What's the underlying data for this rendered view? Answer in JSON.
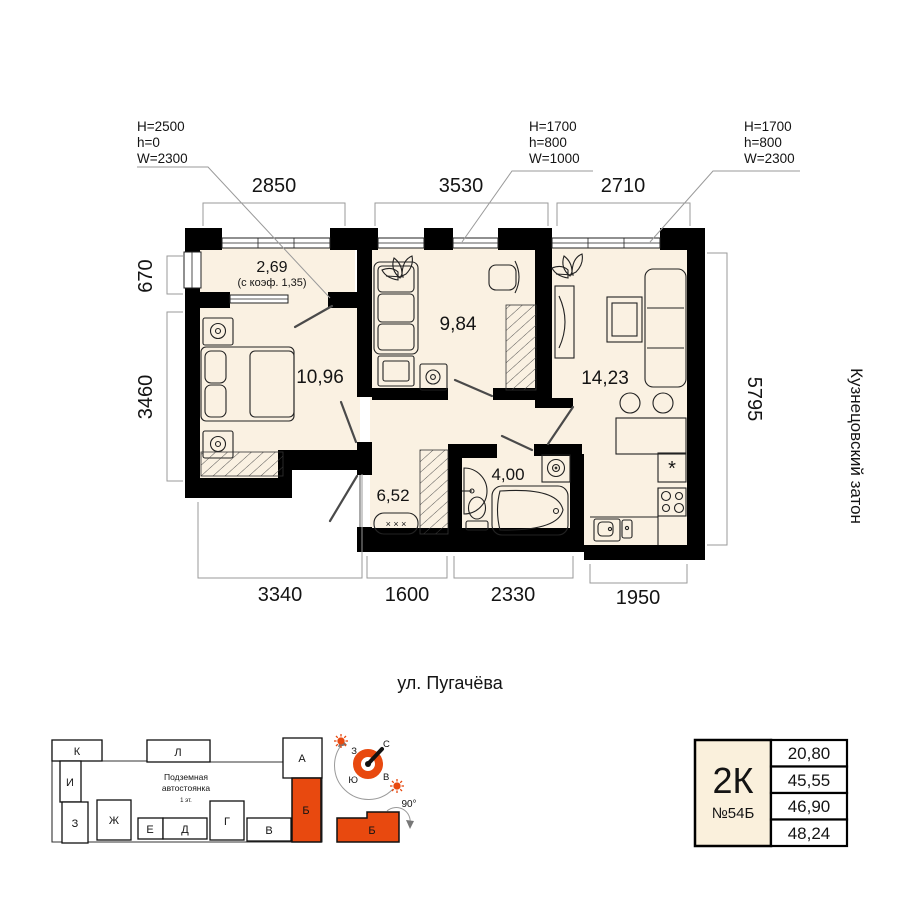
{
  "specs": [
    [
      "H=2500",
      "h=0",
      "W=2300"
    ],
    [
      "H=1700",
      "h=800",
      "W=1000"
    ],
    [
      "H=1700",
      "h=800",
      "W=2300"
    ]
  ],
  "dims": {
    "top": [
      "2850",
      "3530",
      "2710"
    ],
    "left": [
      "670",
      "3460"
    ],
    "right": [
      "5795"
    ],
    "bottom": [
      "3340",
      "1600",
      "2330",
      "1950"
    ]
  },
  "rooms": {
    "balcony_area": "2,69",
    "balcony_note": "(с коэф. 1,35)",
    "bedroom": "10,96",
    "room": "9,84",
    "living": "14,23",
    "hall": "6,52",
    "bath": "4,00"
  },
  "labels": {
    "district": "Кузнецовский затон",
    "street": "ул. Пугачёва"
  },
  "symbols": {
    "fridge": "*",
    "bench": "× × ×"
  },
  "site_plan": {
    "parking": [
      "Подземная",
      "автостоянка"
    ],
    "parking_note": "1 эт.",
    "highlight": "Б",
    "blocks": [
      "К",
      "Л",
      "А",
      "И",
      "Б",
      "З",
      "Ж",
      "Е",
      "Д",
      "Г",
      "В"
    ]
  },
  "compass": {
    "north": "С",
    "south": "Ю",
    "west": "З",
    "east": "В",
    "rotation": "90°",
    "block": "Б"
  },
  "info_box": {
    "type": "2К",
    "number": "№54Б",
    "areas": [
      "20,80",
      "45,55",
      "46,90",
      "48,24"
    ]
  },
  "colors": {
    "accent": "#e8490f",
    "floor": "#faf1e2",
    "wall": "#000000"
  }
}
